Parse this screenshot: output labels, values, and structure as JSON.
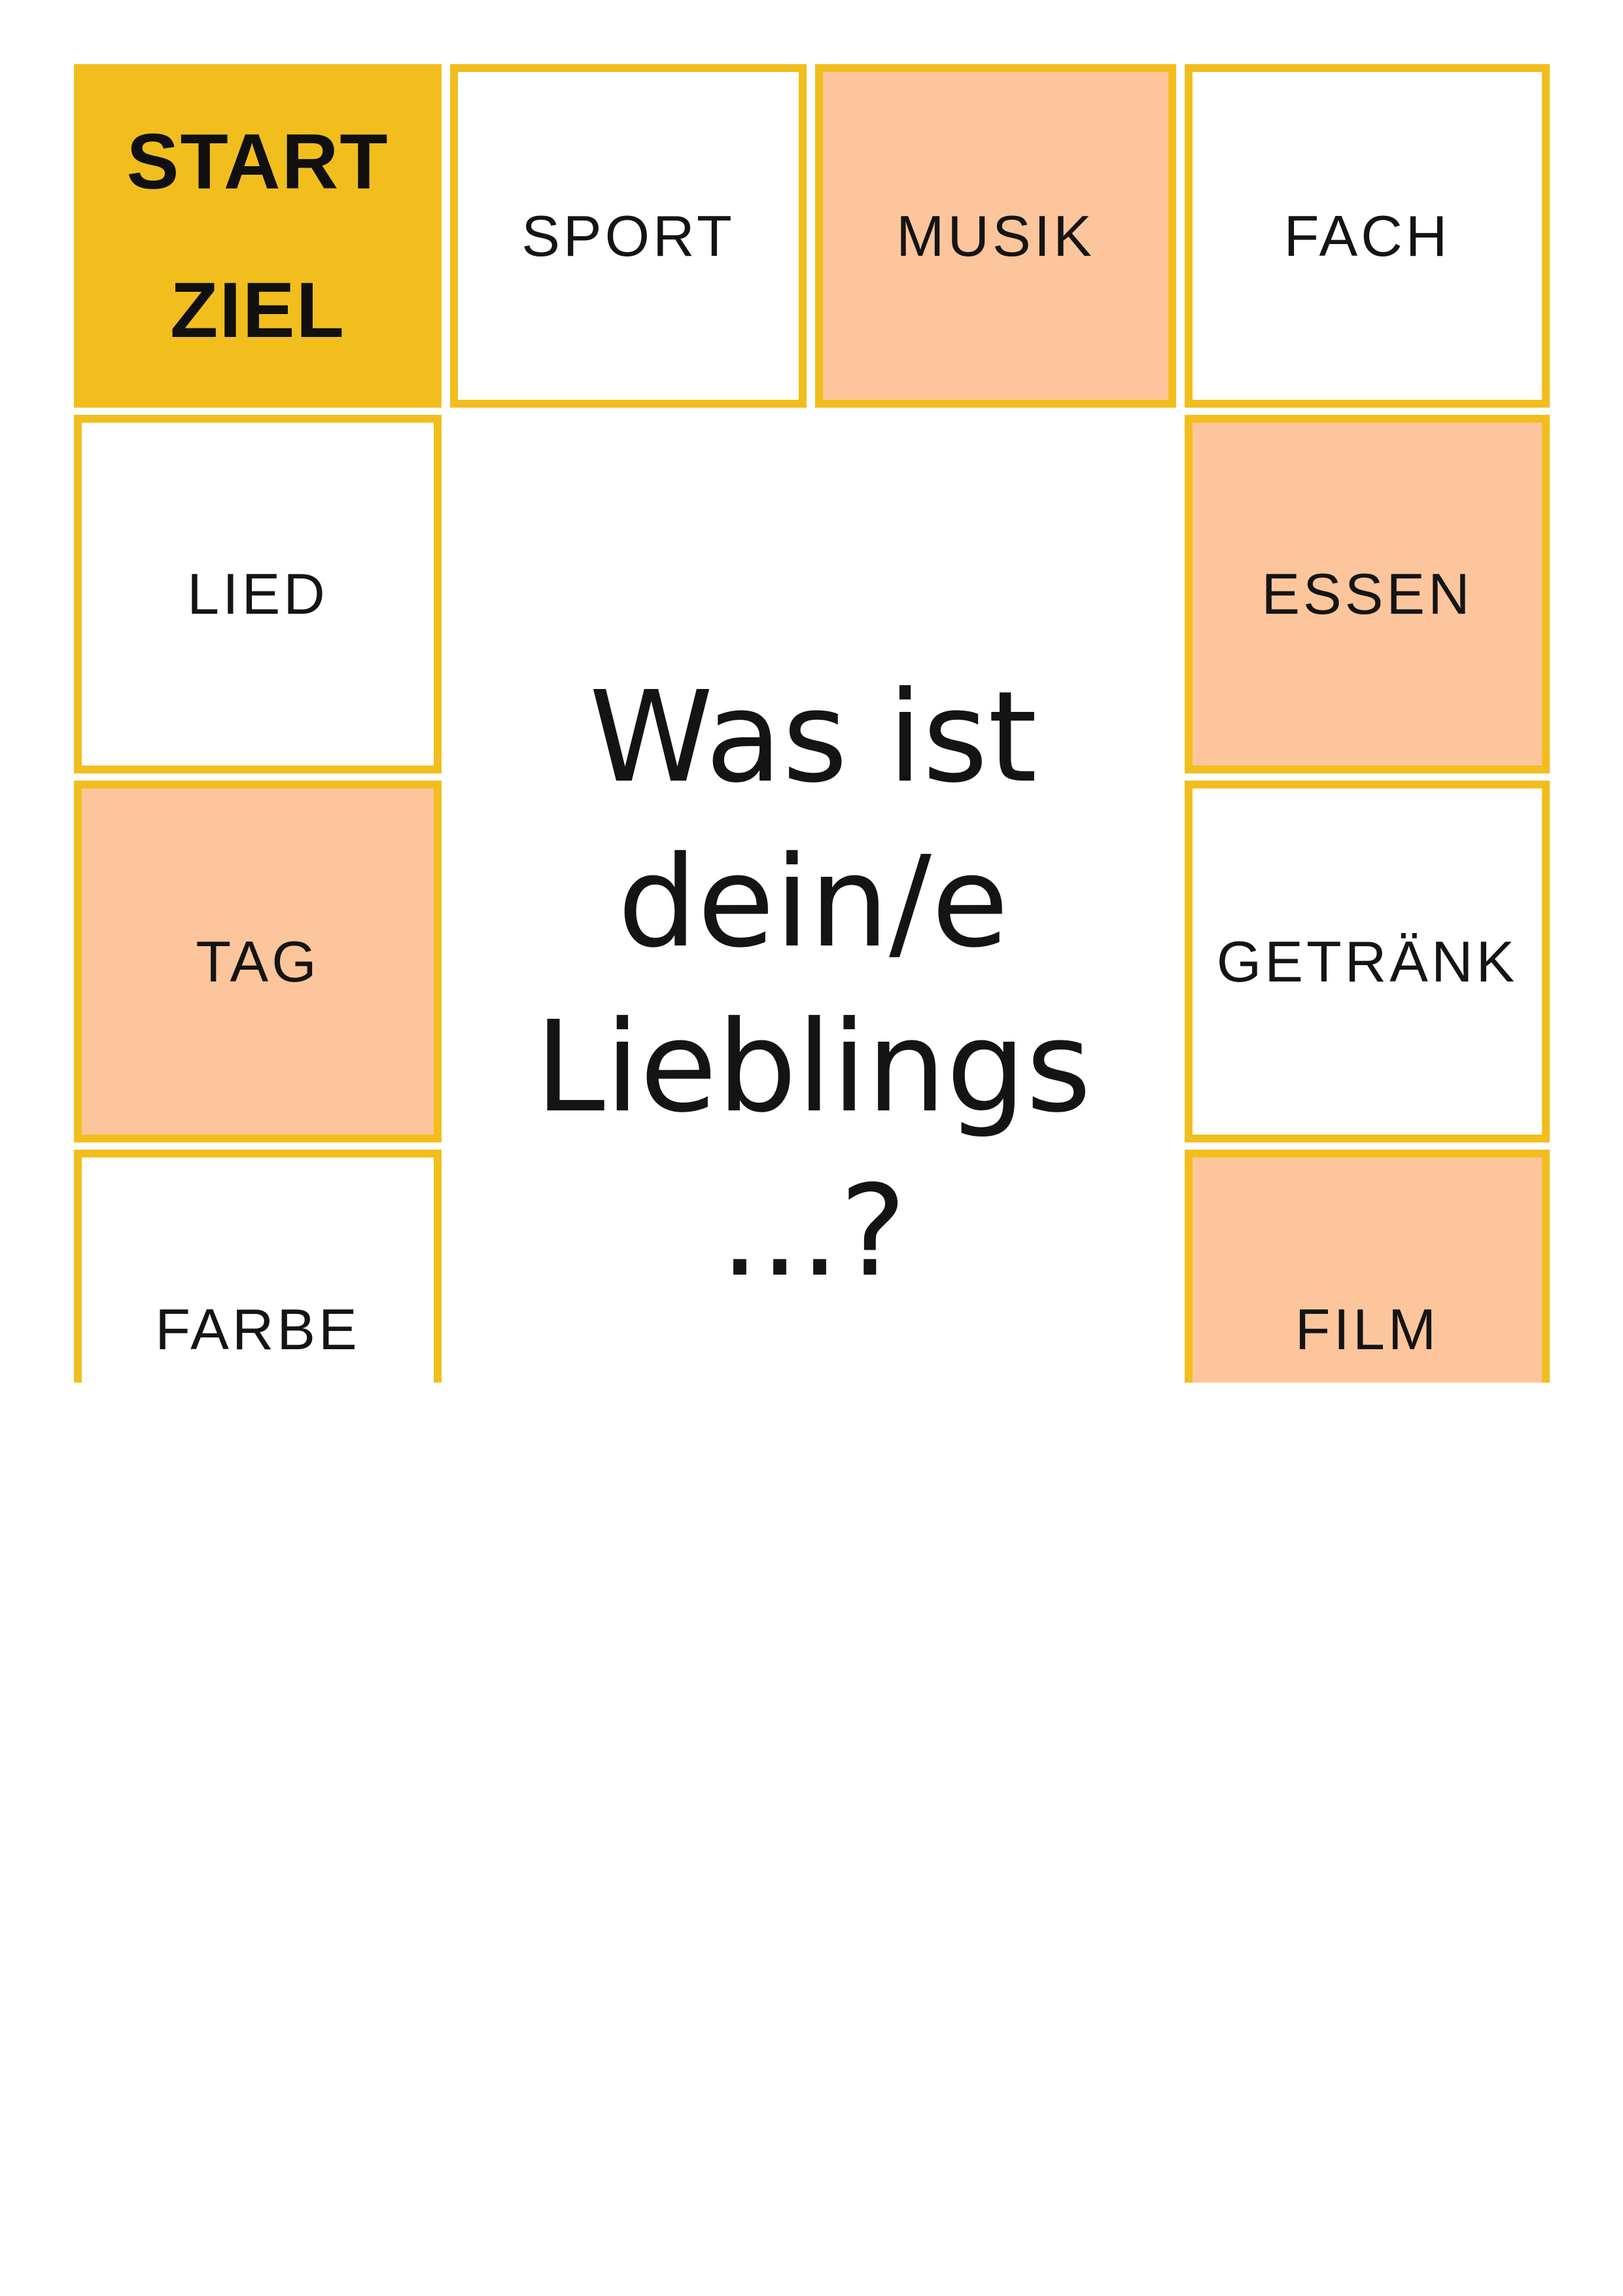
{
  "colors": {
    "yellow": "#F2BE1E",
    "peach": "#FDC59B",
    "ink": "#141414",
    "paper": "#FFFFFF"
  },
  "board": {
    "cells": [
      {
        "id": "start-ziel",
        "lines": [
          "START",
          "ZIEL"
        ],
        "variant": "solid-yellow"
      },
      {
        "id": "sport",
        "label": "SPORT",
        "variant": "white"
      },
      {
        "id": "musik",
        "label": "MUSIK",
        "variant": "peach"
      },
      {
        "id": "fach",
        "label": "FACH",
        "variant": "white"
      },
      {
        "id": "lied",
        "label": "LIED",
        "variant": "white"
      },
      {
        "id": "essen",
        "label": "ESSEN",
        "variant": "peach"
      },
      {
        "id": "tag",
        "label": "TAG",
        "variant": "peach"
      },
      {
        "id": "getraenk",
        "label": "GETRÄNK",
        "variant": "white"
      },
      {
        "id": "farbe",
        "label": "FARBE",
        "variant": "white"
      },
      {
        "id": "film",
        "label": "FILM",
        "variant": "peach"
      }
    ],
    "question": {
      "lines": [
        "Was ist",
        "dein/e",
        "Lieblings",
        "...?"
      ]
    }
  }
}
